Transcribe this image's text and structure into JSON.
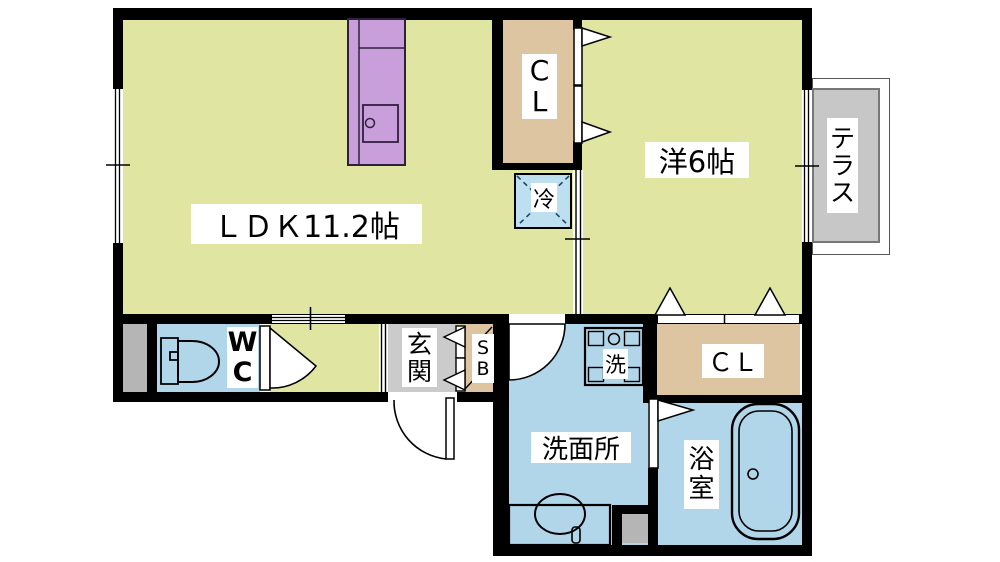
{
  "rooms": {
    "ldk": "ＬＤＫ11.2帖",
    "western_room": "洋6帖",
    "closet_upper": "CL",
    "closet_lower": "ＣＬ",
    "refrigerator": "冷",
    "terrace": "テラス",
    "toilet": "WC",
    "entrance": "玄関",
    "shoe_box": "SB",
    "washroom": "洗面所",
    "bathroom": "浴室",
    "washer": "洗"
  },
  "colors": {
    "floor": "#e1e5a2",
    "wet_room": "#b2d6e9",
    "refrigerator_space": "#bddff0",
    "closet": "#dcc5a0",
    "kitchen_counter": "#c89fdb",
    "terrace": "#c7c7c7",
    "entrance_floor": "#cbcbcb",
    "storage_gray": "#b5b5b5",
    "wall": "#000000"
  }
}
